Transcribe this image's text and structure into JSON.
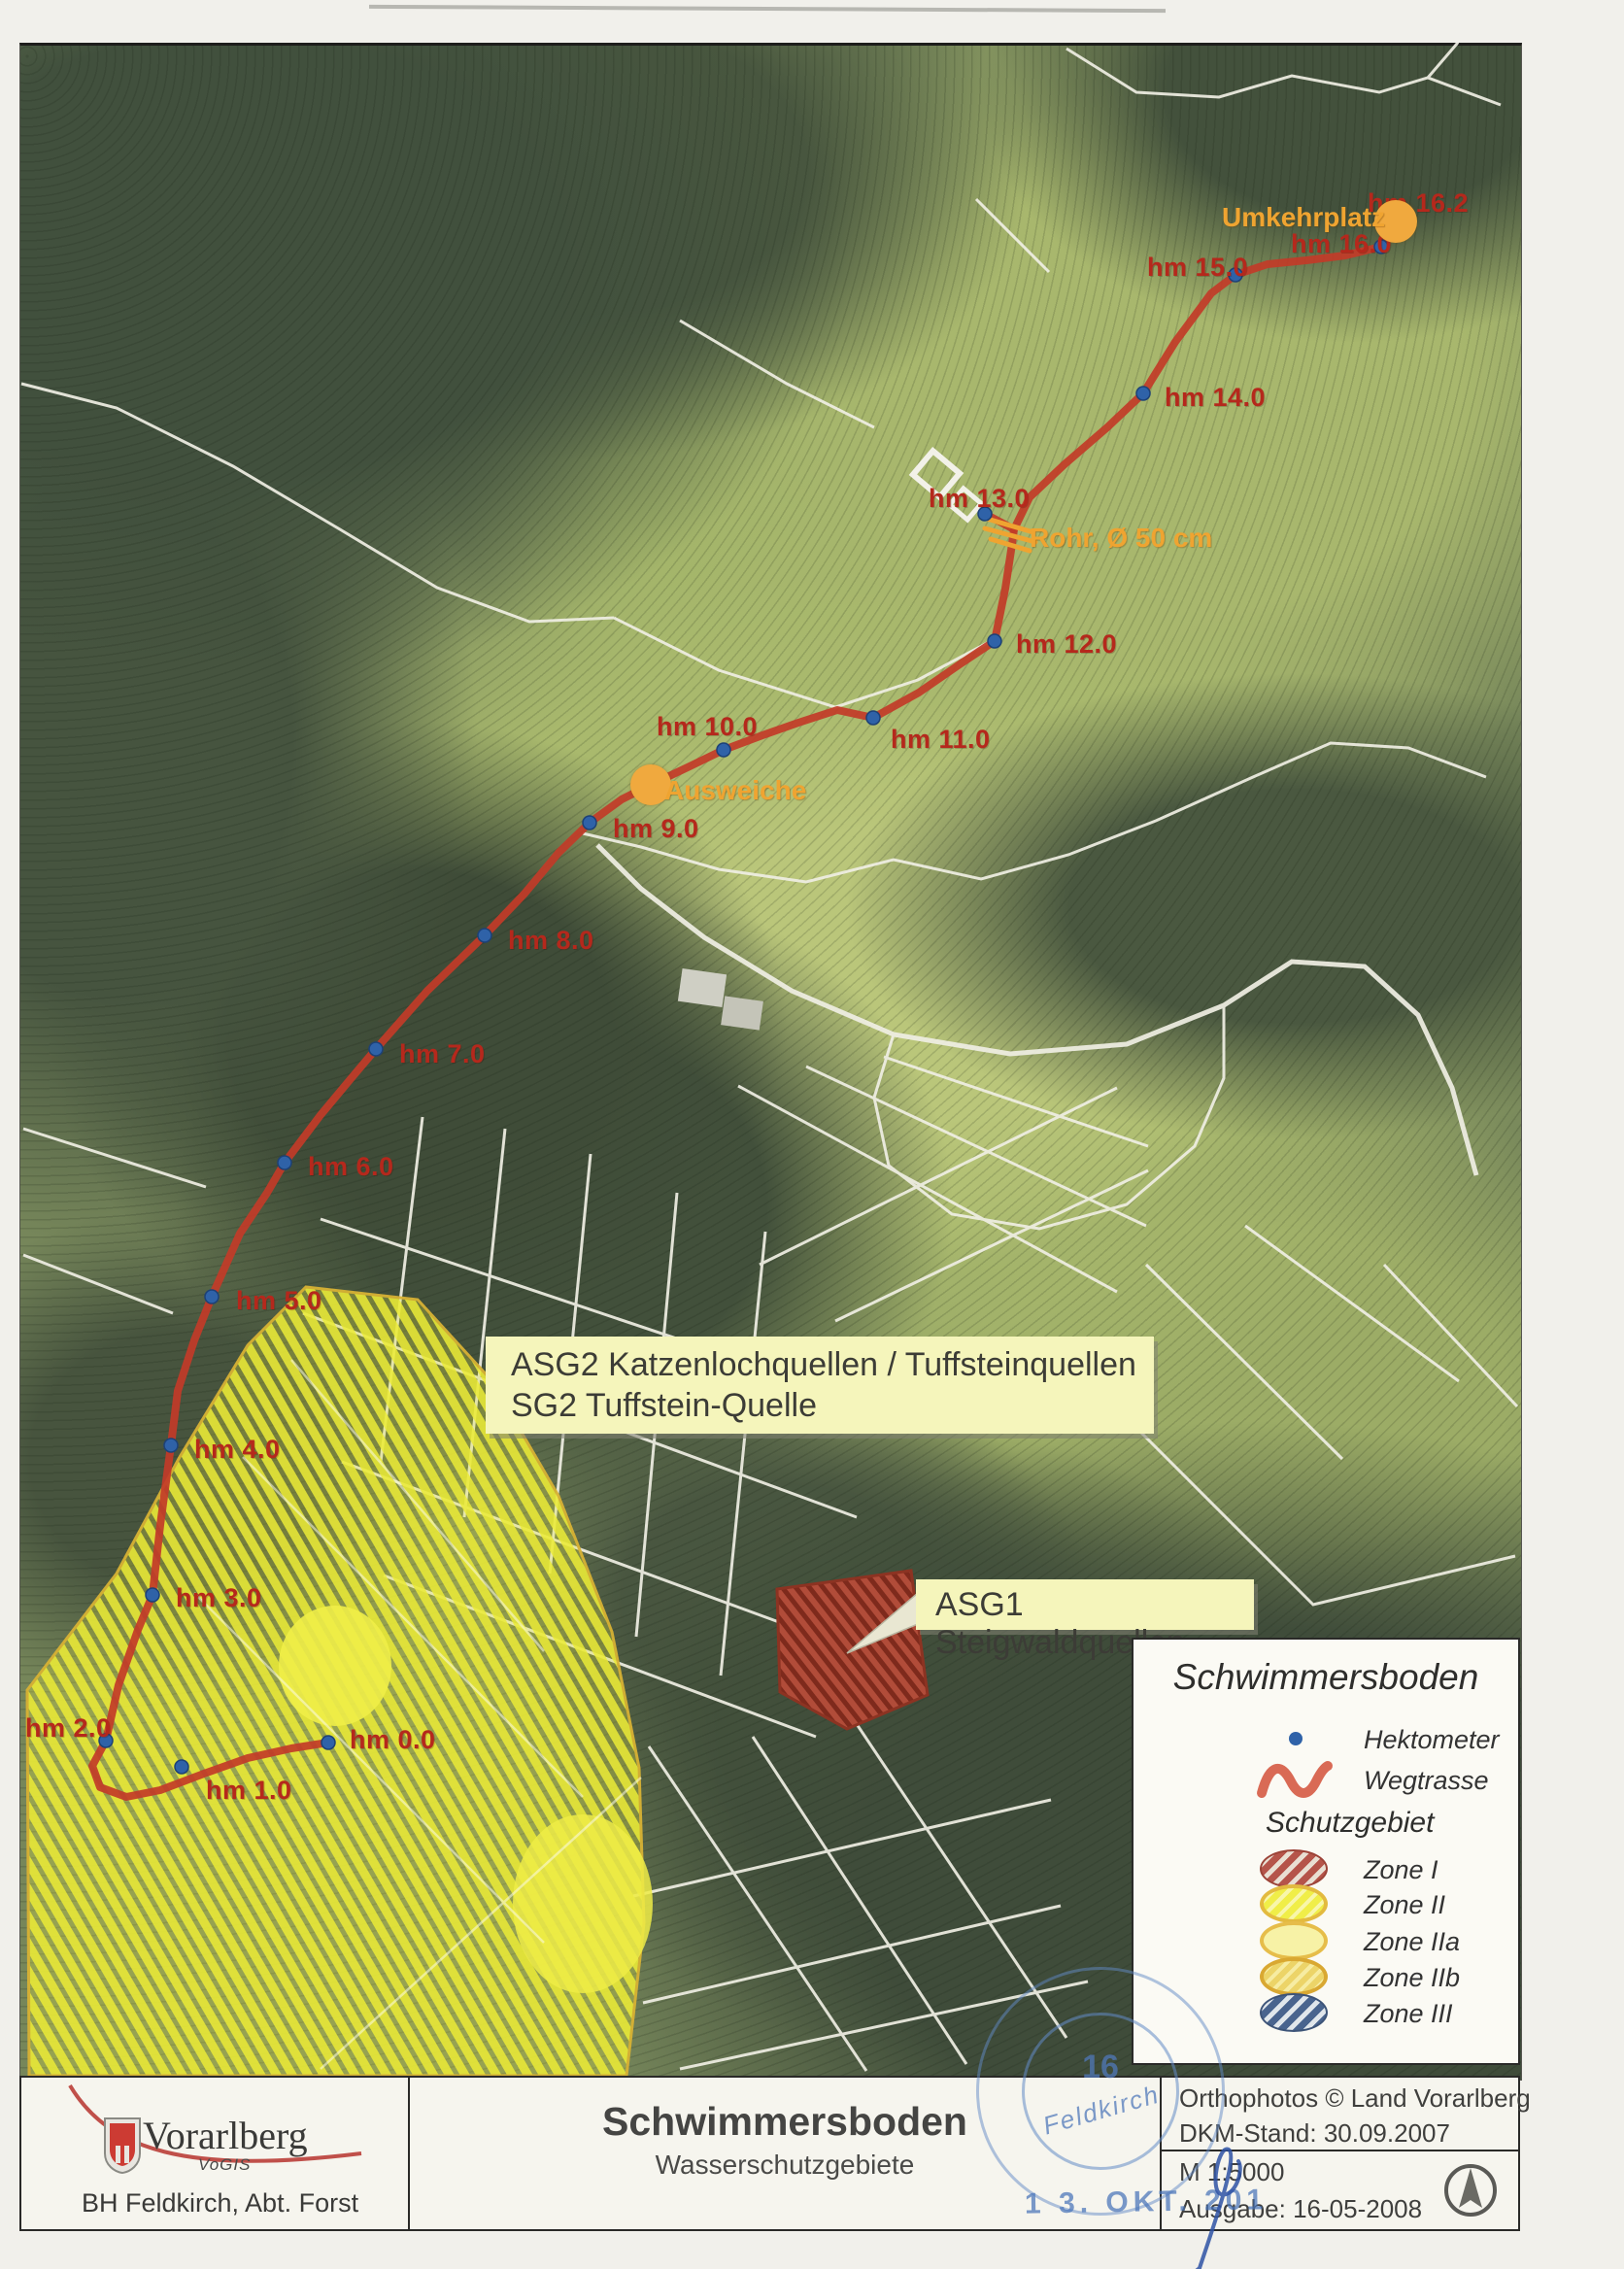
{
  "map": {
    "hm_markers": [
      {
        "label": "hm 0.0",
        "dot": [
          338,
          1794
        ],
        "text": [
          360,
          1776
        ]
      },
      {
        "label": "hm 1.0",
        "dot": [
          187,
          1819
        ],
        "text": [
          212,
          1828
        ]
      },
      {
        "label": "hm 2.0",
        "dot": [
          109,
          1792
        ],
        "text": [
          26,
          1764
        ]
      },
      {
        "label": "hm 3.0",
        "dot": [
          157,
          1642
        ],
        "text": [
          181,
          1630
        ]
      },
      {
        "label": "hm 4.0",
        "dot": [
          176,
          1488
        ],
        "text": [
          200,
          1477
        ]
      },
      {
        "label": "hm 5.0",
        "dot": [
          218,
          1335
        ],
        "text": [
          243,
          1324
        ]
      },
      {
        "label": "hm 6.0",
        "dot": [
          293,
          1197
        ],
        "text": [
          317,
          1186
        ]
      },
      {
        "label": "hm 7.0",
        "dot": [
          387,
          1080
        ],
        "text": [
          411,
          1070
        ]
      },
      {
        "label": "hm 8.0",
        "dot": [
          499,
          963
        ],
        "text": [
          523,
          953
        ]
      },
      {
        "label": "hm 9.0",
        "dot": [
          607,
          847
        ],
        "text": [
          631,
          838
        ]
      },
      {
        "label": "hm 10.0",
        "dot": [
          745,
          772
        ],
        "text": [
          676,
          733
        ]
      },
      {
        "label": "hm 11.0",
        "dot": [
          899,
          739
        ],
        "text": [
          917,
          746
        ]
      },
      {
        "label": "hm 12.0",
        "dot": [
          1024,
          660
        ],
        "text": [
          1046,
          648
        ]
      },
      {
        "label": "hm 13.0",
        "dot": [
          1014,
          529
        ],
        "text": [
          956,
          498
        ]
      },
      {
        "label": "hm 14.0",
        "dot": [
          1177,
          405
        ],
        "text": [
          1199,
          394
        ]
      },
      {
        "label": "hm 15.0",
        "dot": [
          1272,
          283
        ],
        "text": [
          1181,
          260
        ]
      },
      {
        "label": "hm 16.0",
        "dot": [
          1422,
          254
        ],
        "text": [
          1329,
          236
        ]
      },
      {
        "label": "hm 16.2",
        "dot": null,
        "text": [
          1408,
          194
        ]
      }
    ],
    "pois": [
      {
        "name": "Umkehrplatz",
        "circle": [
          1437,
          228
        ],
        "r": 22,
        "text": [
          1258,
          208
        ]
      },
      {
        "name": "Ausweiche",
        "circle": [
          670,
          808
        ],
        "r": 21,
        "text": [
          684,
          798
        ]
      },
      {
        "name": "Rohr, Ø 50 cm",
        "circle": null,
        "r": 0,
        "text": [
          1060,
          538
        ]
      }
    ],
    "route": {
      "points": [
        [
          338,
          1794
        ],
        [
          300,
          1800
        ],
        [
          255,
          1810
        ],
        [
          210,
          1826
        ],
        [
          165,
          1843
        ],
        [
          130,
          1850
        ],
        [
          103,
          1840
        ],
        [
          95,
          1818
        ],
        [
          109,
          1792
        ],
        [
          122,
          1735
        ],
        [
          142,
          1678
        ],
        [
          157,
          1642
        ],
        [
          165,
          1570
        ],
        [
          176,
          1488
        ],
        [
          183,
          1432
        ],
        [
          200,
          1380
        ],
        [
          218,
          1335
        ],
        [
          247,
          1270
        ],
        [
          275,
          1228
        ],
        [
          293,
          1197
        ],
        [
          330,
          1148
        ],
        [
          360,
          1112
        ],
        [
          387,
          1080
        ],
        [
          440,
          1020
        ],
        [
          470,
          991
        ],
        [
          499,
          963
        ],
        [
          540,
          920
        ],
        [
          575,
          878
        ],
        [
          607,
          847
        ],
        [
          640,
          823
        ],
        [
          670,
          808
        ],
        [
          710,
          789
        ],
        [
          745,
          772
        ],
        [
          785,
          757
        ],
        [
          822,
          744
        ],
        [
          862,
          731
        ],
        [
          899,
          739
        ],
        [
          946,
          713
        ],
        [
          988,
          684
        ],
        [
          1024,
          660
        ],
        [
          1035,
          606
        ],
        [
          1042,
          560
        ],
        [
          1044,
          545
        ],
        [
          1060,
          512
        ],
        [
          1096,
          478
        ],
        [
          1140,
          440
        ],
        [
          1177,
          405
        ],
        [
          1210,
          352
        ],
        [
          1247,
          302
        ],
        [
          1272,
          283
        ],
        [
          1305,
          272
        ],
        [
          1345,
          268
        ],
        [
          1385,
          263
        ],
        [
          1422,
          254
        ],
        [
          1437,
          232
        ]
      ],
      "spur": [
        [
          1044,
          545
        ],
        [
          1016,
          530
        ]
      ]
    },
    "annotations": {
      "asg2_line1": "ASG2 Katzenlochquellen / Tuffsteinquellen",
      "asg2_line2": "SG2 Tuffstein-Quelle",
      "asg1": "ASG1 Steigwaldquellen"
    }
  },
  "legend": {
    "title": "Schwimmersboden",
    "hektometer_label": "Hektometer",
    "wegtrasse_label": "Wegtrasse",
    "schutzgebiet_label": "Schutzgebiet",
    "zones": [
      {
        "label": "Zone I",
        "style": "z1"
      },
      {
        "label": "Zone II",
        "style": "z2"
      },
      {
        "label": "Zone IIa",
        "style": "z2a"
      },
      {
        "label": "Zone IIb",
        "style": "z2b"
      },
      {
        "label": "Zone III",
        "style": "z3"
      }
    ]
  },
  "footer": {
    "org": "Vorarlberg",
    "org_sub": "VoGIS",
    "dept": "BH Feldkirch, Abt. Forst",
    "title": "Schwimmersboden",
    "subtitle": "Wasserschutzgebiete",
    "credit1": "Orthophotos © Land Vorarlberg",
    "credit2": "DKM-Stand: 30.09.2007",
    "scale": "M 1:5000",
    "issue": "Ausgabe: 16-05-2008"
  },
  "stamp": {
    "number": "16",
    "city": "Feldkirch",
    "date": "1 3. OKT. 201"
  },
  "colors": {
    "route_red": "#c23b28",
    "hm_label_red": "#b5281c",
    "hektometer_dot_blue": "#2f62a8",
    "poi_orange": "#f0a93e",
    "zone_yellow": "#ebeb3c",
    "zone1_red": "#b14c39",
    "annotation_box_yellow": "#f5f5bb"
  }
}
